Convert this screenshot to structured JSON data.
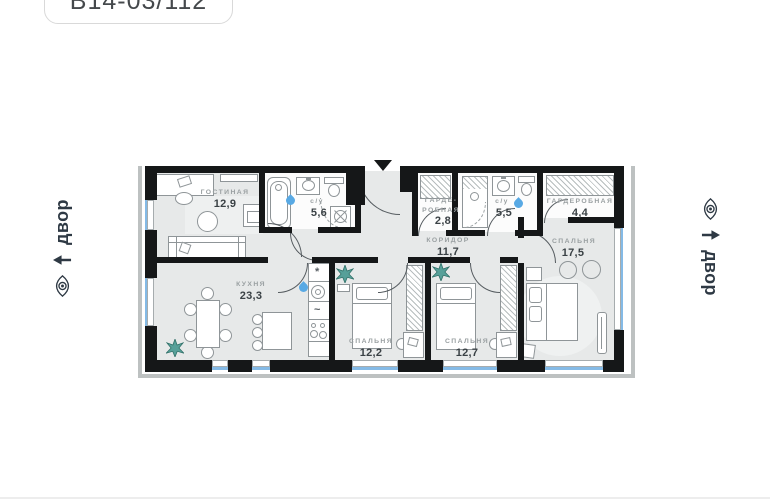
{
  "header": {
    "unit_code": "В14-03/112"
  },
  "orientation": {
    "left_label": "двор",
    "right_label": "двор",
    "icons": [
      "eye-icon",
      "up-arrow-icon"
    ]
  },
  "rooms": [
    {
      "name": "ГОСТИНАЯ",
      "area": "12,9"
    },
    {
      "name": "с/у",
      "area": "5,6"
    },
    {
      "name": "ГАРДЕ-\nРОБНАЯ",
      "area": "2,8"
    },
    {
      "name": "с/у",
      "area": "5,5"
    },
    {
      "name": "ГАРДЕРОБНАЯ",
      "area": "4,4"
    },
    {
      "name": "СПАЛЬНЯ",
      "area": "17,5"
    },
    {
      "name": "КОРИДОР",
      "area": "11,7"
    },
    {
      "name": "КУХНЯ",
      "area": "23,3"
    },
    {
      "name": "СПАЛЬНЯ",
      "area": "12,2"
    },
    {
      "name": "СПАЛЬНЯ",
      "area": "12,7"
    }
  ],
  "kitchen_icons": {
    "extractor": "*",
    "cooktop": "~"
  },
  "colors": {
    "wall": "#151718",
    "floor": "#e7e9e9",
    "window": "#84bae6",
    "facade": "#bdc1c1",
    "label": "#9aa0a2",
    "area_number": "#3a4145",
    "accent_text": "#2e3944",
    "plant": "#57a099",
    "water_drop": "#58a9e4"
  }
}
